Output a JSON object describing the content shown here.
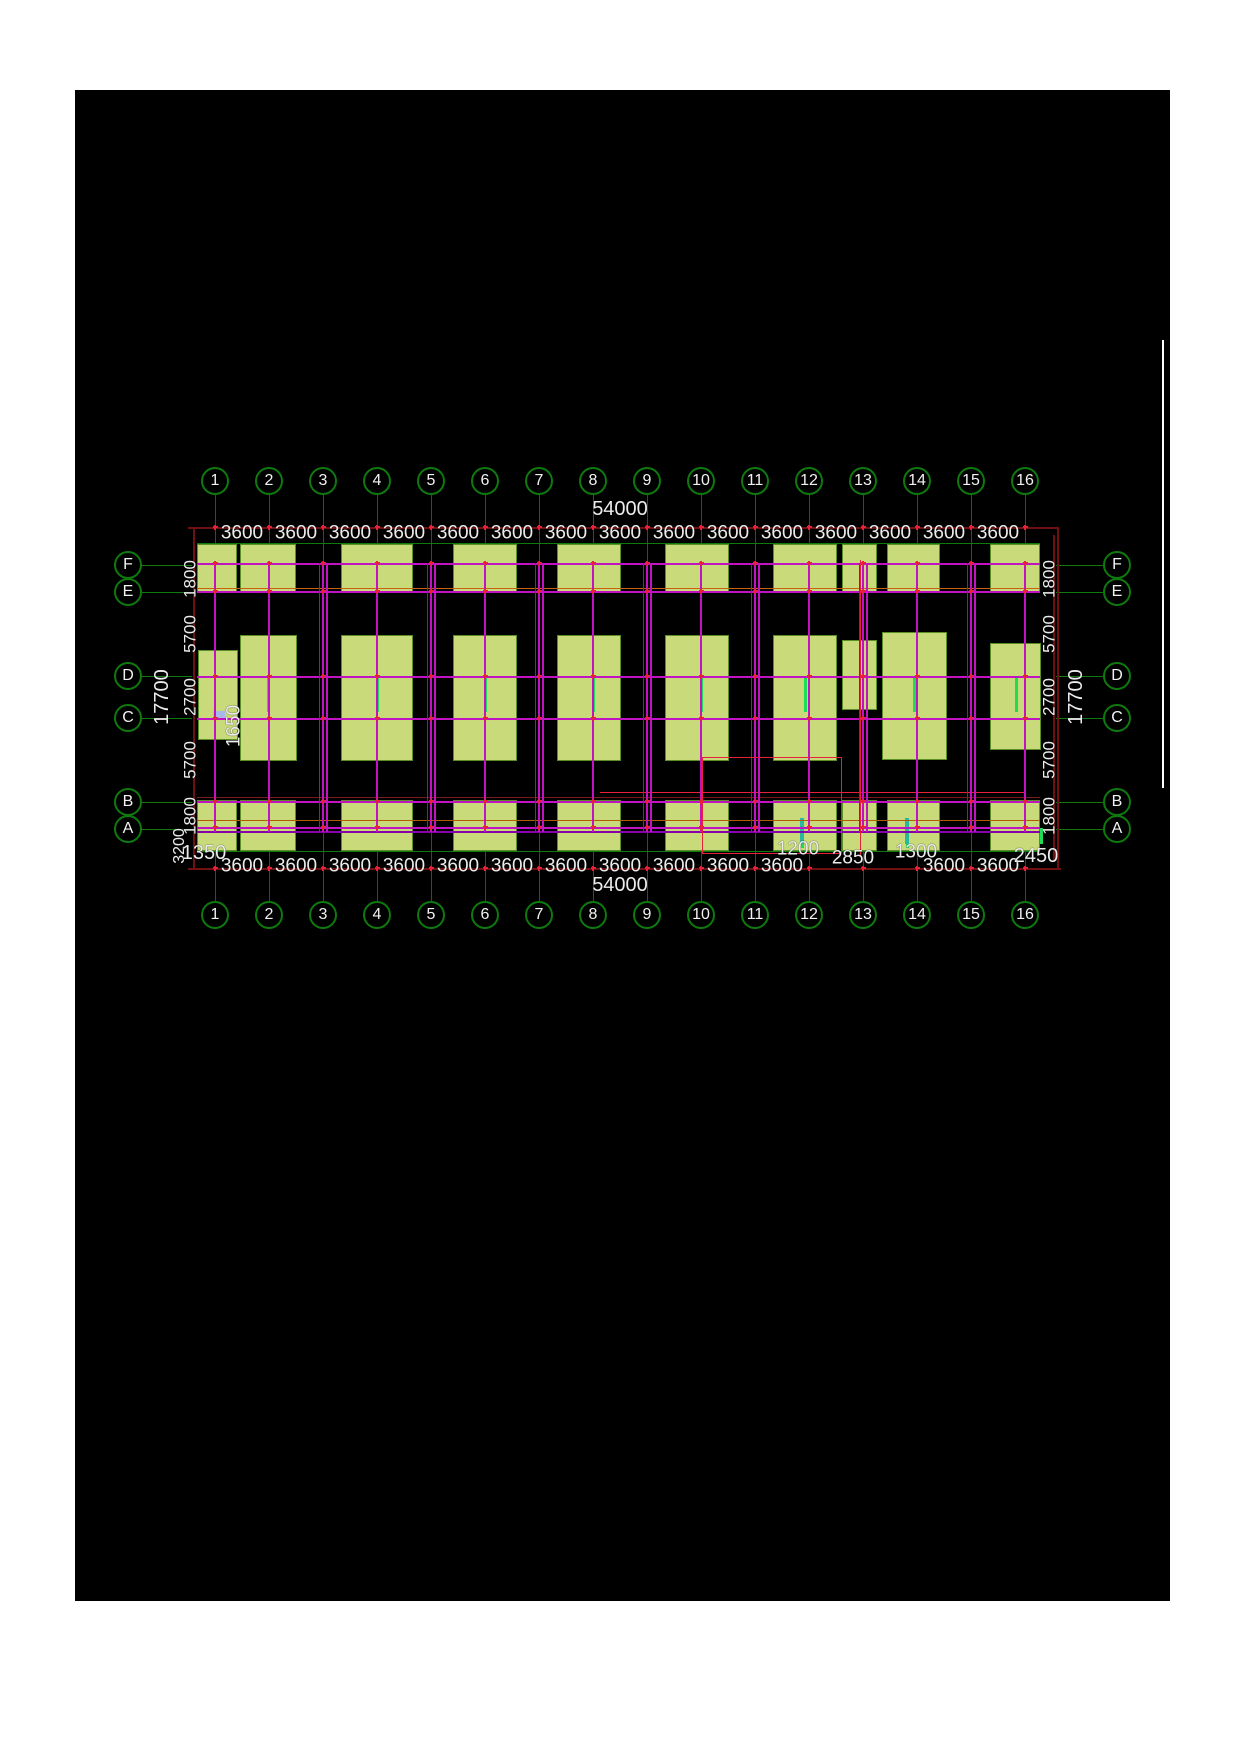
{
  "document": {
    "type": "cad-foundation-plan",
    "background_page": "#ffffff",
    "background_canvas": "#000000"
  },
  "grid": {
    "columns": [
      "1",
      "2",
      "3",
      "4",
      "5",
      "6",
      "7",
      "8",
      "9",
      "10",
      "11",
      "12",
      "13",
      "14",
      "15",
      "16"
    ],
    "rows": [
      "F",
      "E",
      "D",
      "C",
      "B",
      "A"
    ]
  },
  "dimensions": {
    "total_width_top": "54000",
    "total_width_bottom": "54000",
    "bay_label": "3600",
    "bay_count": 15,
    "side_chain": [
      "1800",
      "5700",
      "2700",
      "5700",
      "1800"
    ],
    "side_total": "17700",
    "bottom_extras": [
      {
        "t": "1200",
        "x": 798,
        "y": 849,
        "fs": 19
      },
      {
        "t": "2850",
        "x": 853,
        "y": 858,
        "fs": 19
      },
      {
        "t": "1300",
        "x": 916,
        "y": 852,
        "fs": 19
      },
      {
        "t": "2450",
        "x": 1036,
        "y": 856,
        "fs": 20
      }
    ],
    "bottom_left_offset": "1350",
    "left_rotated_extra": "3200",
    "interior_dim": "1650"
  },
  "colors": {
    "grid_green": "#0e7a0e",
    "leader_green": "#0c660c",
    "bright_green": "#1ddc55",
    "teal": "#28b8a0",
    "footing_fill": "#c8da79",
    "footing_edge": "#5a8f28",
    "magenta": "#c213c2",
    "deep_purple": "#8800aa",
    "blue": "#4433bb",
    "dim_darkred": "#701010",
    "red": "#e8203a",
    "orange": "#c86010",
    "orange2": "#b35900",
    "darkline": "#7a1a1a",
    "text": "#ececec",
    "white_line": "#ffffff",
    "lavender": "#a8b8e8"
  },
  "geometry": {
    "canvas": {
      "x": 75,
      "y": 90,
      "w": 1095,
      "h": 1511
    },
    "grid_x0": 215,
    "bay_px": 54,
    "rows_y": {
      "F": 565,
      "E": 592,
      "D": 676,
      "C": 718,
      "B": 802,
      "A": 829
    },
    "top_bubble_y": 481,
    "bottom_bubble_y": 915,
    "left_bubble_x": 128,
    "right_bubble_x": 1117,
    "bubble_d": 28,
    "top_dim_y": 533,
    "bottom_dim_y": 866,
    "top_total_y": 509,
    "bottom_total_y": 885,
    "dimline_top_y": 527,
    "dimline_bottom_y": 868,
    "plan_left": 197,
    "plan_right": 1040,
    "bottom_bays_shown": [
      0,
      1,
      2,
      3,
      4,
      5,
      6,
      7,
      8,
      9,
      10,
      13,
      14
    ]
  },
  "footings": {
    "top_band": [
      [
        197,
        544,
        40,
        49
      ],
      [
        240,
        544,
        56,
        49
      ],
      [
        341,
        544,
        72,
        49
      ],
      [
        453,
        544,
        64,
        49
      ],
      [
        557,
        544,
        64,
        49
      ],
      [
        665,
        544,
        64,
        49
      ],
      [
        773,
        544,
        64,
        49
      ],
      [
        842,
        544,
        35,
        49
      ],
      [
        887,
        544,
        53,
        49
      ],
      [
        990,
        544,
        50,
        49
      ]
    ],
    "middle_band": [
      [
        198,
        650,
        40,
        90
      ],
      [
        240,
        635,
        57,
        126
      ],
      [
        341,
        635,
        72,
        126
      ],
      [
        453,
        635,
        64,
        126
      ],
      [
        557,
        635,
        64,
        126
      ],
      [
        665,
        635,
        64,
        126
      ],
      [
        773,
        635,
        64,
        126
      ],
      [
        842,
        640,
        35,
        70
      ],
      [
        882,
        632,
        65,
        128
      ],
      [
        990,
        643,
        51,
        107
      ]
    ],
    "bottom_band": [
      [
        197,
        800,
        40,
        51
      ],
      [
        240,
        800,
        56,
        51
      ],
      [
        341,
        800,
        72,
        51
      ],
      [
        453,
        800,
        64,
        51
      ],
      [
        557,
        800,
        64,
        51
      ],
      [
        665,
        800,
        64,
        51
      ],
      [
        773,
        800,
        64,
        51
      ],
      [
        842,
        800,
        35,
        51
      ],
      [
        887,
        800,
        53,
        51
      ],
      [
        990,
        800,
        50,
        51
      ]
    ]
  },
  "wall_horizontals": [
    {
      "y": 563,
      "c": "magenta",
      "w": 2
    },
    {
      "y": 588,
      "c": "orange",
      "w": 1
    },
    {
      "y": 591,
      "c": "magenta",
      "w": 2
    },
    {
      "y": 676,
      "c": "magenta",
      "w": 2
    },
    {
      "y": 718,
      "c": "magenta",
      "w": 2
    },
    {
      "y": 792,
      "c": "red",
      "w": 1,
      "x1": 600,
      "x2": 1025
    },
    {
      "y": 797,
      "c": "darkline",
      "w": 1
    },
    {
      "y": 801,
      "c": "magenta",
      "w": 2
    },
    {
      "y": 820,
      "c": "orange2",
      "w": 1
    },
    {
      "y": 827,
      "c": "magenta",
      "w": 2
    },
    {
      "y": 831,
      "c": "deep_purple",
      "w": 2
    }
  ],
  "red_extras": {
    "vertical_x860": {
      "x": 860,
      "y1": 560,
      "y2": 855
    },
    "rect": {
      "x1": 702,
      "x2": 841,
      "y1": 757,
      "y2": 853
    }
  },
  "green_ticks": [
    [
      267,
      678,
      3,
      34
    ],
    [
      376,
      678,
      3,
      34
    ],
    [
      484,
      678,
      3,
      34
    ],
    [
      592,
      678,
      3,
      34
    ],
    [
      700,
      678,
      3,
      34
    ],
    [
      804,
      678,
      3,
      34
    ],
    [
      913,
      678,
      3,
      34
    ],
    [
      1015,
      678,
      3,
      34
    ],
    [
      801,
      830,
      3,
      18
    ],
    [
      906,
      830,
      3,
      18
    ],
    [
      1040,
      828,
      3,
      16
    ]
  ],
  "teal_ticks": [
    [
      800,
      818,
      4,
      26
    ],
    [
      905,
      818,
      4,
      26
    ]
  ],
  "lavender_tick": [
    213,
    711,
    12,
    7
  ],
  "white_edge_line": {
    "x": 1162,
    "y1": 340,
    "y2": 788
  },
  "plus_rows": [
    527,
    563,
    591,
    676,
    718,
    801,
    827,
    868
  ]
}
